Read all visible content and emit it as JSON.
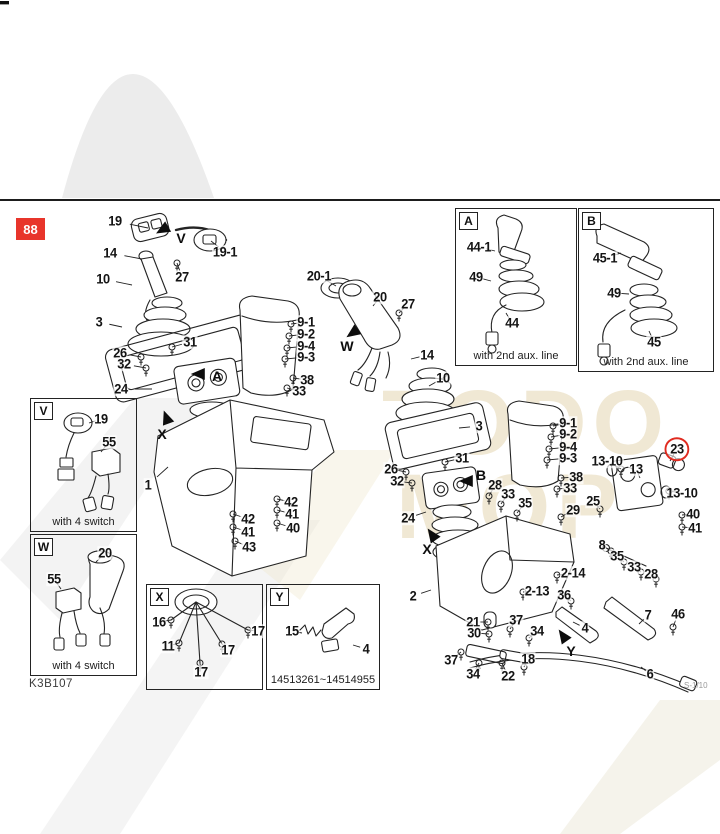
{
  "page": {
    "code": "88",
    "footer_left": "K3B107",
    "footer_right": "S-1/10"
  },
  "watermark": {
    "line1": "TODO",
    "line2": "MOP"
  },
  "insets": [
    {
      "letter": "A",
      "caption": "with 2nd aux. line",
      "x": 455,
      "y": 208,
      "w": 122,
      "h": 158
    },
    {
      "letter": "B",
      "caption": "with 2nd aux. line",
      "x": 578,
      "y": 208,
      "w": 136,
      "h": 164
    },
    {
      "letter": "V",
      "caption": "with 4 switch",
      "x": 30,
      "y": 398,
      "w": 107,
      "h": 134
    },
    {
      "letter": "W",
      "caption": "with 4 switch",
      "x": 30,
      "y": 534,
      "w": 107,
      "h": 142
    },
    {
      "letter": "X",
      "caption": "",
      "x": 146,
      "y": 584,
      "w": 117,
      "h": 106
    },
    {
      "letter": "Y",
      "caption": "14513261~14514955",
      "x": 266,
      "y": 584,
      "w": 114,
      "h": 106
    }
  ],
  "arrows": [
    {
      "letter": "V",
      "ax": 164,
      "ay": 229,
      "angle": 150,
      "lx": 181,
      "ly": 238
    },
    {
      "letter": "A",
      "ax": 200,
      "ay": 374,
      "angle": 180,
      "lx": 217,
      "ly": 376
    },
    {
      "letter": "X",
      "ax": 167,
      "ay": 419,
      "angle": 250,
      "lx": 162,
      "ly": 434
    },
    {
      "letter": "W",
      "ax": 354,
      "ay": 332,
      "angle": 145,
      "lx": 347,
      "ly": 346
    },
    {
      "letter": "B",
      "ax": 468,
      "ay": 481,
      "angle": 180,
      "lx": 481,
      "ly": 475
    },
    {
      "letter": "X",
      "ax": 433,
      "ay": 536,
      "angle": 235,
      "lx": 427,
      "ly": 549
    },
    {
      "letter": "Y",
      "ax": 564,
      "ay": 637,
      "angle": 235,
      "lx": 571,
      "ly": 651
    }
  ],
  "big_parts": [
    "1",
    "2",
    "3",
    "4",
    "5",
    "6",
    "7",
    "10",
    "13",
    "14",
    "15",
    "19",
    "19-1",
    "20",
    "20-1",
    "23",
    "24",
    "44",
    "44-1",
    "45",
    "45-1",
    "49",
    "55"
  ],
  "labels": [
    {
      "t": "19",
      "x": 115,
      "y": 221,
      "tx": 148,
      "ty": 228
    },
    {
      "t": "19-1",
      "x": 225,
      "y": 252,
      "tx": 211,
      "ty": 241
    },
    {
      "t": "14",
      "x": 110,
      "y": 253,
      "tx": 142,
      "ty": 259
    },
    {
      "t": "27",
      "x": 182,
      "y": 277,
      "tx": 177,
      "ty": 263
    },
    {
      "t": "10",
      "x": 103,
      "y": 279,
      "tx": 132,
      "ty": 285
    },
    {
      "t": "3",
      "x": 99,
      "y": 322,
      "tx": 122,
      "ty": 327
    },
    {
      "t": "26",
      "x": 120,
      "y": 353,
      "tx": 141,
      "ty": 357
    },
    {
      "t": "31",
      "x": 190,
      "y": 342,
      "tx": 172,
      "ty": 347
    },
    {
      "t": "32",
      "x": 124,
      "y": 364,
      "tx": 146,
      "ty": 368
    },
    {
      "t": "24",
      "x": 121,
      "y": 389,
      "tx": 152,
      "ty": 389
    },
    {
      "t": "1",
      "x": 148,
      "y": 485,
      "tx": 168,
      "ty": 467
    },
    {
      "t": "42",
      "x": 248,
      "y": 519,
      "tx": 233,
      "ty": 514
    },
    {
      "t": "41",
      "x": 248,
      "y": 532,
      "tx": 233,
      "ty": 527
    },
    {
      "t": "43",
      "x": 249,
      "y": 547,
      "tx": 235,
      "ty": 541
    },
    {
      "t": "42",
      "x": 291,
      "y": 502,
      "tx": 277,
      "ty": 499
    },
    {
      "t": "41",
      "x": 292,
      "y": 514,
      "tx": 277,
      "ty": 510
    },
    {
      "t": "40",
      "x": 293,
      "y": 528,
      "tx": 277,
      "ty": 523
    },
    {
      "t": "20-1",
      "x": 319,
      "y": 276,
      "tx": 336,
      "ty": 286
    },
    {
      "t": "20",
      "x": 380,
      "y": 297,
      "tx": 373,
      "ty": 306
    },
    {
      "t": "27",
      "x": 408,
      "y": 304,
      "tx": 399,
      "ty": 313
    },
    {
      "t": "9-1",
      "x": 306,
      "y": 322,
      "tx": 291,
      "ty": 324
    },
    {
      "t": "9-2",
      "x": 306,
      "y": 334,
      "tx": 289,
      "ty": 336
    },
    {
      "t": "9-4",
      "x": 306,
      "y": 346,
      "tx": 287,
      "ty": 348
    },
    {
      "t": "9-3",
      "x": 306,
      "y": 357,
      "tx": 285,
      "ty": 359
    },
    {
      "t": "38",
      "x": 307,
      "y": 380,
      "tx": 293,
      "ty": 378
    },
    {
      "t": "33",
      "x": 299,
      "y": 391,
      "tx": 287,
      "ty": 388
    },
    {
      "t": "14",
      "x": 427,
      "y": 355,
      "tx": 411,
      "ty": 359
    },
    {
      "t": "10",
      "x": 443,
      "y": 378,
      "tx": 429,
      "ty": 386
    },
    {
      "t": "3",
      "x": 479,
      "y": 426,
      "tx": 459,
      "ty": 428
    },
    {
      "t": "31",
      "x": 462,
      "y": 458,
      "tx": 445,
      "ty": 462
    },
    {
      "t": "26",
      "x": 391,
      "y": 469,
      "tx": 406,
      "ty": 472
    },
    {
      "t": "32",
      "x": 397,
      "y": 481,
      "tx": 412,
      "ty": 483
    },
    {
      "t": "24",
      "x": 408,
      "y": 518,
      "tx": 426,
      "ty": 512
    },
    {
      "t": "28",
      "x": 495,
      "y": 485,
      "tx": 489,
      "ty": 496
    },
    {
      "t": "33",
      "x": 508,
      "y": 494,
      "tx": 501,
      "ty": 504
    },
    {
      "t": "35",
      "x": 525,
      "y": 503,
      "tx": 517,
      "ty": 513
    },
    {
      "t": "29",
      "x": 573,
      "y": 510,
      "tx": 561,
      "ty": 517
    },
    {
      "t": "9-1",
      "x": 568,
      "y": 423,
      "tx": 553,
      "ty": 426
    },
    {
      "t": "9-2",
      "x": 568,
      "y": 434,
      "tx": 551,
      "ty": 437
    },
    {
      "t": "9-4",
      "x": 568,
      "y": 447,
      "tx": 549,
      "ty": 449
    },
    {
      "t": "9-3",
      "x": 568,
      "y": 458,
      "tx": 547,
      "ty": 460
    },
    {
      "t": "38",
      "x": 576,
      "y": 477,
      "tx": 561,
      "ty": 478
    },
    {
      "t": "33",
      "x": 570,
      "y": 488,
      "tx": 557,
      "ty": 489
    },
    {
      "t": "13-10",
      "x": 607,
      "y": 461,
      "tx": 621,
      "ty": 469
    },
    {
      "t": "13",
      "x": 636,
      "y": 469,
      "tx": 640,
      "ty": 478
    },
    {
      "t": "23",
      "x": 677,
      "y": 449,
      "tx": 670,
      "ty": 461,
      "circled": true
    },
    {
      "t": "13-10",
      "x": 682,
      "y": 493,
      "tx": 669,
      "ty": 491
    },
    {
      "t": "25",
      "x": 593,
      "y": 501,
      "tx": 600,
      "ty": 509
    },
    {
      "t": "40",
      "x": 693,
      "y": 514,
      "tx": 682,
      "ty": 515
    },
    {
      "t": "41",
      "x": 695,
      "y": 528,
      "tx": 682,
      "ty": 527
    },
    {
      "t": "8",
      "x": 602,
      "y": 545,
      "tx": 611,
      "ty": 551
    },
    {
      "t": "35",
      "x": 617,
      "y": 556,
      "tx": 624,
      "ty": 562
    },
    {
      "t": "33",
      "x": 634,
      "y": 567,
      "tx": 641,
      "ty": 572
    },
    {
      "t": "28",
      "x": 651,
      "y": 574,
      "tx": 656,
      "ty": 579
    },
    {
      "t": "2-14",
      "x": 573,
      "y": 573,
      "tx": 557,
      "ty": 575
    },
    {
      "t": "2-13",
      "x": 537,
      "y": 591,
      "tx": 523,
      "ty": 592
    },
    {
      "t": "36",
      "x": 564,
      "y": 595,
      "tx": 571,
      "ty": 601
    },
    {
      "t": "2",
      "x": 413,
      "y": 596,
      "tx": 431,
      "ty": 590
    },
    {
      "t": "21",
      "x": 473,
      "y": 622,
      "tx": 488,
      "ty": 622
    },
    {
      "t": "30",
      "x": 474,
      "y": 633,
      "tx": 489,
      "ty": 634
    },
    {
      "t": "37",
      "x": 451,
      "y": 660,
      "tx": 461,
      "ty": 652
    },
    {
      "t": "34",
      "x": 473,
      "y": 674,
      "tx": 479,
      "ty": 663
    },
    {
      "t": "22",
      "x": 508,
      "y": 676,
      "tx": 502,
      "ty": 663
    },
    {
      "t": "37",
      "x": 516,
      "y": 620,
      "tx": 510,
      "ty": 629
    },
    {
      "t": "34",
      "x": 537,
      "y": 631,
      "tx": 529,
      "ty": 638
    },
    {
      "t": "18",
      "x": 528,
      "y": 659,
      "tx": 524,
      "ty": 667
    },
    {
      "t": "4",
      "x": 585,
      "y": 628,
      "tx": 573,
      "ty": 622
    },
    {
      "t": "7",
      "x": 648,
      "y": 615,
      "tx": 639,
      "ty": 624
    },
    {
      "t": "46",
      "x": 678,
      "y": 614,
      "tx": 673,
      "ty": 627
    },
    {
      "t": "6",
      "x": 650,
      "y": 674,
      "tx": 641,
      "ty": 667
    },
    {
      "t": "44-1",
      "x": 479,
      "y": 247,
      "tx": 495,
      "ty": 251
    },
    {
      "t": "49",
      "x": 476,
      "y": 277,
      "tx": 491,
      "ty": 281
    },
    {
      "t": "44",
      "x": 512,
      "y": 323,
      "tx": 506,
      "ty": 313
    },
    {
      "t": "45-1",
      "x": 605,
      "y": 258,
      "tx": 621,
      "ty": 253
    },
    {
      "t": "49",
      "x": 614,
      "y": 293,
      "tx": 629,
      "ty": 294
    },
    {
      "t": "45",
      "x": 654,
      "y": 342,
      "tx": 649,
      "ty": 331
    },
    {
      "t": "19",
      "x": 101,
      "y": 419,
      "tx": 89,
      "ty": 423
    },
    {
      "t": "55",
      "x": 109,
      "y": 442,
      "tx": 101,
      "ty": 452
    },
    {
      "t": "20",
      "x": 105,
      "y": 553,
      "tx": 96,
      "ty": 562
    },
    {
      "t": "55",
      "x": 54,
      "y": 579,
      "tx": 61,
      "ty": 589
    },
    {
      "t": "16",
      "x": 159,
      "y": 622,
      "tx": 171,
      "ty": 620
    },
    {
      "t": "11",
      "x": 168,
      "y": 646,
      "tx": 179,
      "ty": 643
    },
    {
      "t": "17",
      "x": 258,
      "y": 631,
      "tx": 248,
      "ty": 630
    },
    {
      "t": "17",
      "x": 228,
      "y": 650,
      "tx": 222,
      "ty": 644
    },
    {
      "t": "17",
      "x": 201,
      "y": 672,
      "tx": 200,
      "ty": 663
    },
    {
      "t": "15",
      "x": 292,
      "y": 631,
      "tx": 302,
      "ty": 633
    },
    {
      "t": "4",
      "x": 366,
      "y": 649,
      "tx": 353,
      "ty": 645
    }
  ]
}
